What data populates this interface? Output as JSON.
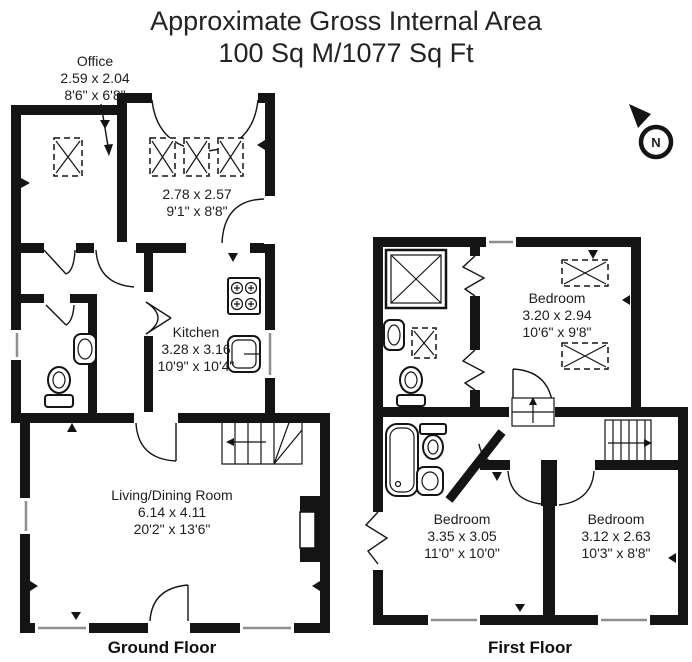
{
  "title": {
    "line1": "Approximate Gross Internal Area",
    "line2": "100 Sq M/1077 Sq Ft"
  },
  "compass": {
    "label": "N"
  },
  "ground_floor": {
    "label": "Ground Floor",
    "office": {
      "name": "Office",
      "metric": "2.59 x 2.04",
      "imperial": "8'6\" x 6'8\""
    },
    "top_room": {
      "metric": "2.78 x 2.57",
      "imperial": "9'1\" x 8'8\""
    },
    "kitchen": {
      "name": "Kitchen",
      "metric": "3.28 x 3.16",
      "imperial": "10'9\" x 10'4\""
    },
    "living_dining": {
      "name": "Living/Dining Room",
      "metric": "6.14 x 4.11",
      "imperial": "20'2\" x 13'6\""
    }
  },
  "first_floor": {
    "label": "First Floor",
    "bedroom1": {
      "name": "Bedroom",
      "metric": "3.20 x 2.94",
      "imperial": "10'6\" x 9'8\""
    },
    "bedroom2": {
      "name": "Bedroom",
      "metric": "3.35 x 3.05",
      "imperial": "11'0\" x 10'0\""
    },
    "bedroom3": {
      "name": "Bedroom",
      "metric": "3.12 x 2.63",
      "imperial": "10'3\" x 8'8\""
    }
  },
  "colors": {
    "wall": "#141414",
    "text": "#1d1d1f",
    "background": "#ffffff"
  }
}
